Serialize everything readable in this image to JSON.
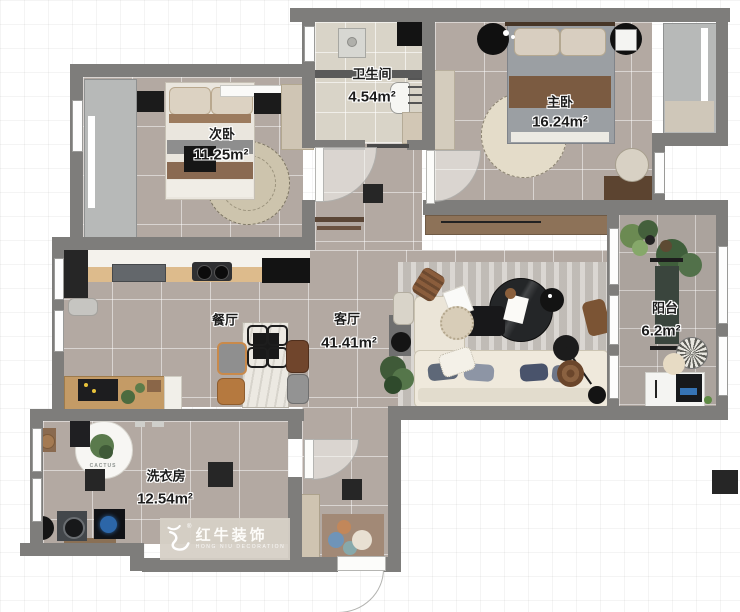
{
  "watermark": {
    "brand": "红牛装饰",
    "brand_en": "HONG NIU DECORATION",
    "registered": "®"
  },
  "rooms": [
    {
      "id": "bathroom",
      "name": "卫生间",
      "area": "4.54m²"
    },
    {
      "id": "master-bedroom",
      "name": "主卧",
      "area": "16.24m²"
    },
    {
      "id": "second-bedroom",
      "name": "次卧",
      "area": "11.25m²"
    },
    {
      "id": "dining-room",
      "name": "餐厅",
      "area": ""
    },
    {
      "id": "living-room",
      "name": "客厅",
      "area": "41.41m²"
    },
    {
      "id": "balcony",
      "name": "阳台",
      "area": "6.2m²"
    },
    {
      "id": "laundry-room",
      "name": "洗衣房",
      "area": "12.54m²"
    }
  ],
  "decor": {
    "laundry_rug_text": "CACTUS"
  },
  "colors": {
    "wall": "#7e7d7b",
    "floor_tile": "#b3a9a2",
    "bathroom_tile": "#d9d4c8",
    "balcony_tile": "#aba39d",
    "kitchen_wood": "#ddbb8c",
    "watermark_bg": "#d8d2c7"
  }
}
